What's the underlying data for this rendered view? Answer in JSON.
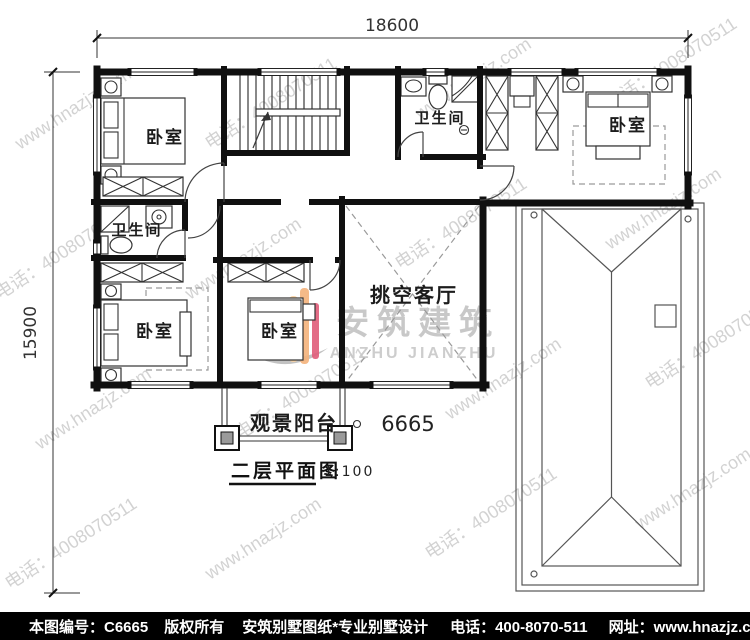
{
  "dimensions": {
    "width_label": "18600",
    "height_label": "15900"
  },
  "rooms": {
    "bedroom_tl": "卧室",
    "bath_top": "卫生间",
    "bedroom_tr": "卧室",
    "bath_left": "卫生间",
    "bedroom_bl": "卧室",
    "bedroom_bm": "卧室",
    "living_void": "挑空客厅",
    "balcony": "观景阳台"
  },
  "plan": {
    "number": "6665",
    "title": "二层平面图",
    "scale": "1:100"
  },
  "watermark": {
    "site": "www.hnazjz.com",
    "phone": "电话：4008070511",
    "logo_cn": "安筑建筑",
    "logo_en": "ANZHU JIANZHU"
  },
  "footer": {
    "sheet_no": "本图编号：C6665",
    "copyright": "版权所有",
    "brand": "安筑别墅图纸*专业别墅设计",
    "phone": "电话：400-8070-511",
    "website": "网址：www.hnazjz.com"
  },
  "colors": {
    "wall": "#101010",
    "watermark": "#c2c2c2",
    "logo_teal": "#7fd7cc",
    "logo_peach": "#f9d2a3",
    "logo_orange": "#f5b37c",
    "logo_red": "#e05d7a",
    "footer_bg": "#000000",
    "footer_text": "#ffffff"
  }
}
